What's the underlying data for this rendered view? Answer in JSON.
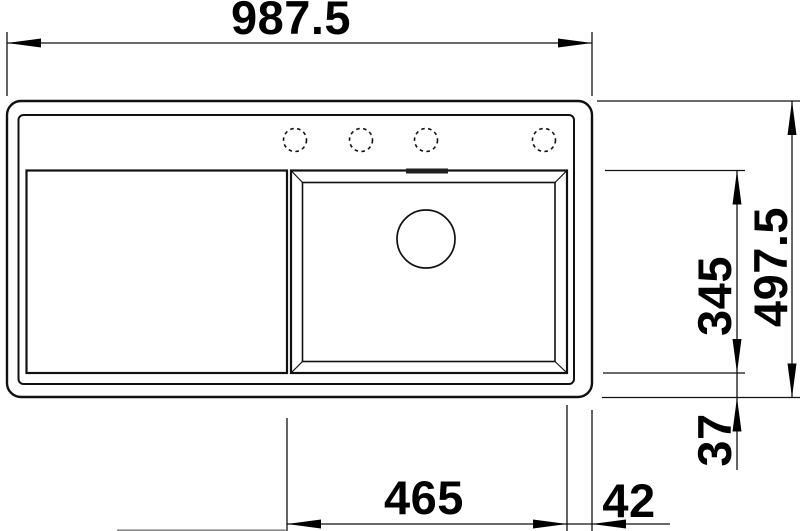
{
  "page": {
    "background": "#ffffff"
  },
  "drawing": {
    "type": "technical-dimension-drawing",
    "subject": "kitchen sink top view with drainboard, bowl, drain and faucet holes",
    "line_color": "#111111",
    "text_color": "#000000",
    "overflow_slot_fill": "#1f1f1f",
    "faucet_hole_count": 4,
    "dims": {
      "overall_width": "987.5",
      "overall_depth": "497.5",
      "bowl_depth": "345",
      "bowl_bottom_offset": "37",
      "bowl_width": "465",
      "rim_right_width": "42"
    }
  }
}
